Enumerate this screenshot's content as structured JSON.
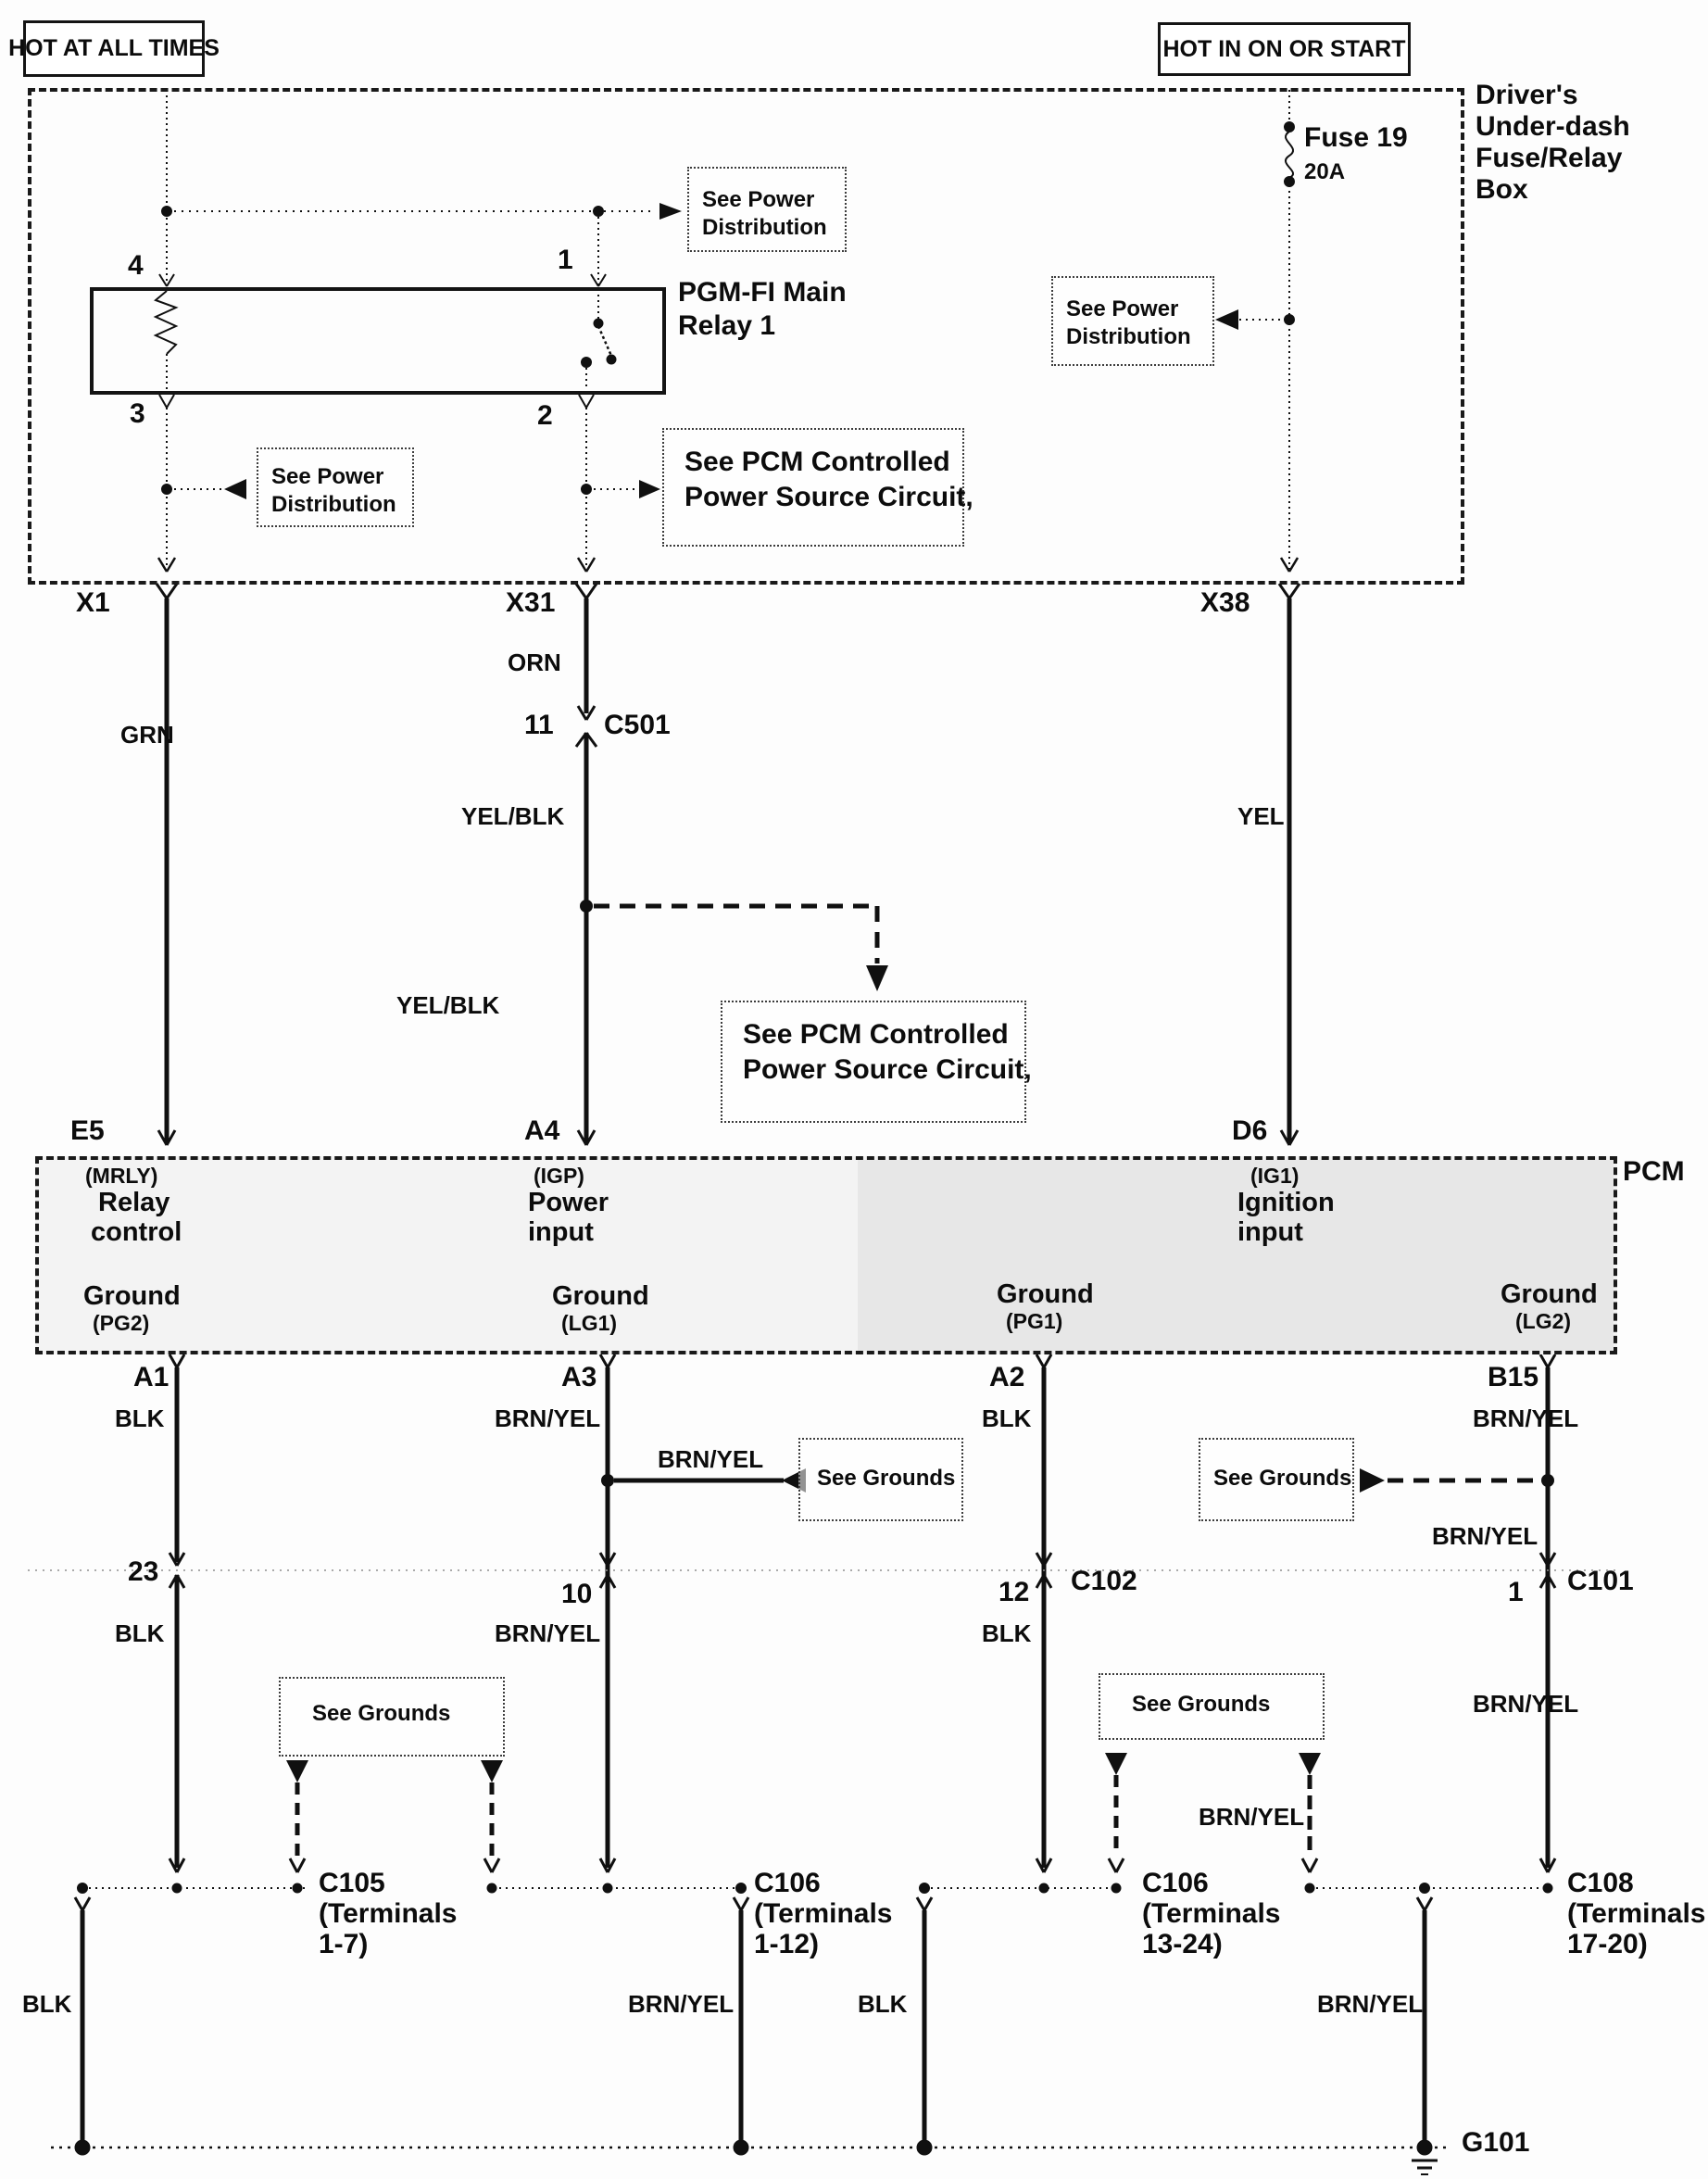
{
  "power_labels": {
    "left": "HOT AT ALL TIMES",
    "right": "HOT IN ON OR START"
  },
  "fuse_relay_box": {
    "title": [
      "Driver's",
      "Under-dash",
      "Fuse/Relay",
      "Box"
    ],
    "fuse": {
      "name": "Fuse 19",
      "rating": "20A"
    },
    "relay": {
      "name": [
        "PGM-FI Main",
        "Relay 1"
      ],
      "pins": {
        "p1": "1",
        "p2": "2",
        "p3": "3",
        "p4": "4"
      }
    }
  },
  "refs": {
    "see_power": [
      "See Power",
      "Distribution"
    ],
    "see_pcm": [
      "See PCM Controlled",
      "Power Source Circuit,"
    ],
    "see_grounds": "See Grounds"
  },
  "connectors": {
    "x1": "X1",
    "x31": "X31",
    "x38": "X38",
    "c501": "C501",
    "c501_pin": "11",
    "c102": "C102",
    "c102_pin": "12",
    "c101": "C101",
    "c101_pin": "1",
    "pin_23": "23",
    "pin_10": "10",
    "c105": [
      "C105",
      "(Terminals",
      "1-7)"
    ],
    "c106a": [
      "C106",
      "(Terminals",
      "1-12)"
    ],
    "c106b": [
      "C106",
      "(Terminals",
      "13-24)"
    ],
    "c108": [
      "C108",
      "(Terminals",
      "17-20)"
    ],
    "g101": "G101"
  },
  "wires": {
    "grn": "GRN",
    "orn": "ORN",
    "yel_blk": "YEL/BLK",
    "yel": "YEL",
    "blk": "BLK",
    "brn_yel": "BRN/YEL"
  },
  "pcm": {
    "name": "PCM",
    "terminals": {
      "e5": "E5",
      "a4": "A4",
      "d6": "D6",
      "a1": "A1",
      "a3": "A3",
      "a2": "A2",
      "b15": "B15"
    },
    "functions": {
      "mrly": {
        "code": "(MRLY)",
        "desc": [
          "Relay",
          "control"
        ]
      },
      "igp": {
        "code": "(IGP)",
        "desc": [
          "Power",
          "input"
        ]
      },
      "ig1": {
        "code": "(IG1)",
        "desc": [
          "Ignition",
          "input"
        ]
      }
    },
    "grounds": [
      {
        "label": "Ground",
        "code": "(PG2)"
      },
      {
        "label": "Ground",
        "code": "(LG1)"
      },
      {
        "label": "Ground",
        "code": "(PG1)"
      },
      {
        "label": "Ground",
        "code": "(LG2)"
      }
    ]
  }
}
